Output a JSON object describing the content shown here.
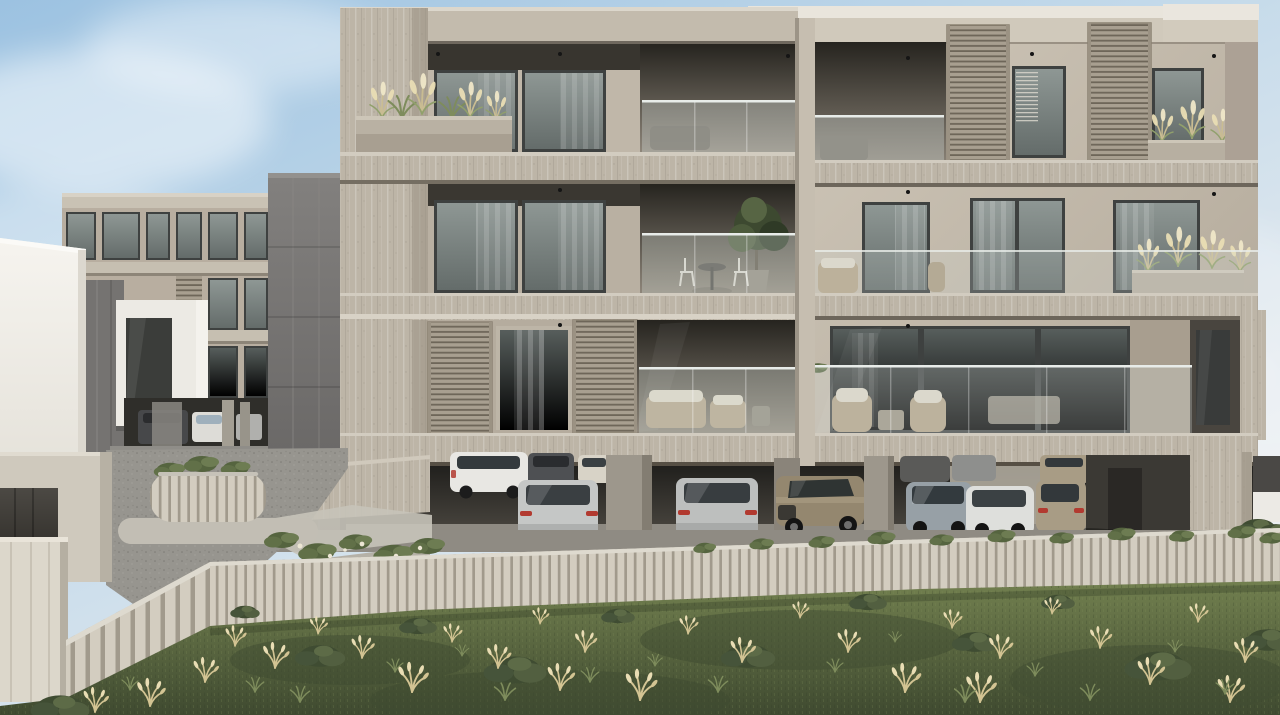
{
  "scene": {
    "type": "exterior architectural 3D render",
    "subject": "Modern three-storey apartment complex with recessed balconies, sliding slatted louver shutters, glass balustrades and open ground-floor parking, fronted by a timber slat fence and a wild grass meadow",
    "camera": "street-level frontal view",
    "lighting": "bright daylight, soft diffuse shadows",
    "sky": {
      "top": "#9cc2e1",
      "mid": "#c4daea",
      "horizon": "#e2e9ef",
      "clouds": "soft white wisps"
    },
    "buildings": {
      "main": {
        "storeys": 3,
        "features": [
          "travertine slab bands",
          "recessed balconies",
          "glass balustrades",
          "sliding timber louver shutters",
          "floor-to-ceiling windows with sheer curtains",
          "pampas grass planters",
          "wicker outdoor furniture",
          "open ground-floor car park on pilotis"
        ]
      },
      "left_background": {
        "storeys": 3,
        "features": [
          "beige facade",
          "white projecting window box",
          "dark concrete flank wall",
          "small louver shutter",
          "carport with parked cars"
        ]
      },
      "far_left": {
        "type": "white building fragment"
      },
      "stair_core": {
        "type": "dark board-marked concrete tower between buildings"
      }
    },
    "vehicles": [
      {
        "position": "left carport",
        "type": "suv",
        "color": "#47484a"
      },
      {
        "position": "left carport",
        "type": "sedan",
        "color": "#dddcd7"
      },
      {
        "position": "garage back row",
        "type": "suv",
        "color": "#e8e7e3"
      },
      {
        "position": "garage back row",
        "type": "suv",
        "color": "#4e5053"
      },
      {
        "position": "garage back row",
        "type": "hatchback",
        "color": "#d8d3c7"
      },
      {
        "position": "garage front row",
        "type": "estate",
        "color": "#c5c7c6"
      },
      {
        "position": "garage front row",
        "type": "estate",
        "color": "#bdbfbe"
      },
      {
        "position": "garage front row",
        "type": "suv",
        "color": "#94876f"
      },
      {
        "position": "garage front row",
        "type": "sedan",
        "color": "#97a0a6"
      },
      {
        "position": "garage front row",
        "type": "crossover",
        "color": "#dedfdc"
      },
      {
        "position": "garage front row",
        "type": "estate",
        "color": "#a89c85"
      }
    ],
    "vegetation": {
      "meadow": [
        "wild green grass",
        "dry wheat-coloured tufts",
        "dark green shrubs"
      ],
      "balconies": [
        "pampas grass planters",
        "potted tree",
        "hanging vine"
      ],
      "fence_line": [
        "climbing greenery"
      ],
      "driveway": [
        "curved slatted planter with shrubs",
        "low hedge with white blooms"
      ]
    },
    "foreground": {
      "fence": "light timber slat fence",
      "driveway": "gravel drive with concrete kerbs and walk",
      "gate": "light concrete gate wall with dark opening"
    }
  },
  "palette": {
    "sky-top": "#9cc2e1",
    "sky-mid": "#c4daea",
    "sky-low": "#e2e9ef",
    "wall-lit": "#c9c0b2",
    "wall-mid": "#b8aea0",
    "wall-shade": "#a89e8f",
    "trav": "#bdb5a7",
    "trav-light": "#d2ccc0",
    "trav-dark": "#a1988a",
    "soffit": "#34312c",
    "recess-top": "#26241f",
    "recess-bottom": "#8d8579",
    "glass-hi": "#8e9794",
    "glass-lo": "#646c6a",
    "frame": "#3e4140",
    "curtain": "#c8c1b4",
    "louver": "#a89f90",
    "louver-gap": "#6e6659",
    "balustrade": "#d7e0dc",
    "white-building": "#f2f0eb",
    "tower-hi": "#82807e",
    "tower-lo": "#636160",
    "fence": "#d3cdc0",
    "fence-gap": "#a19a8c",
    "asphalt": "#97958f",
    "apron": "#b5b1a7",
    "walk": "#c7c3b9",
    "grass-hi": "#72804f",
    "grass-lo": "#3f4a30",
    "bush": "#3f4c32",
    "wheat": "#d3c493",
    "wheat-bright": "#e9ddb4",
    "car-white": "#e8e7e3",
    "car-silver": "#c5c7c6",
    "car-gray": "#4e5053",
    "car-bronze": "#94876f",
    "car-tan": "#a89c85",
    "car-blue": "#97a0a6",
    "car-cream": "#d8d3c7",
    "taillight": "#b23a30",
    "garage-top": "#21201d",
    "garage-bottom": "#4e4a43",
    "floor": "#8e8a82"
  }
}
